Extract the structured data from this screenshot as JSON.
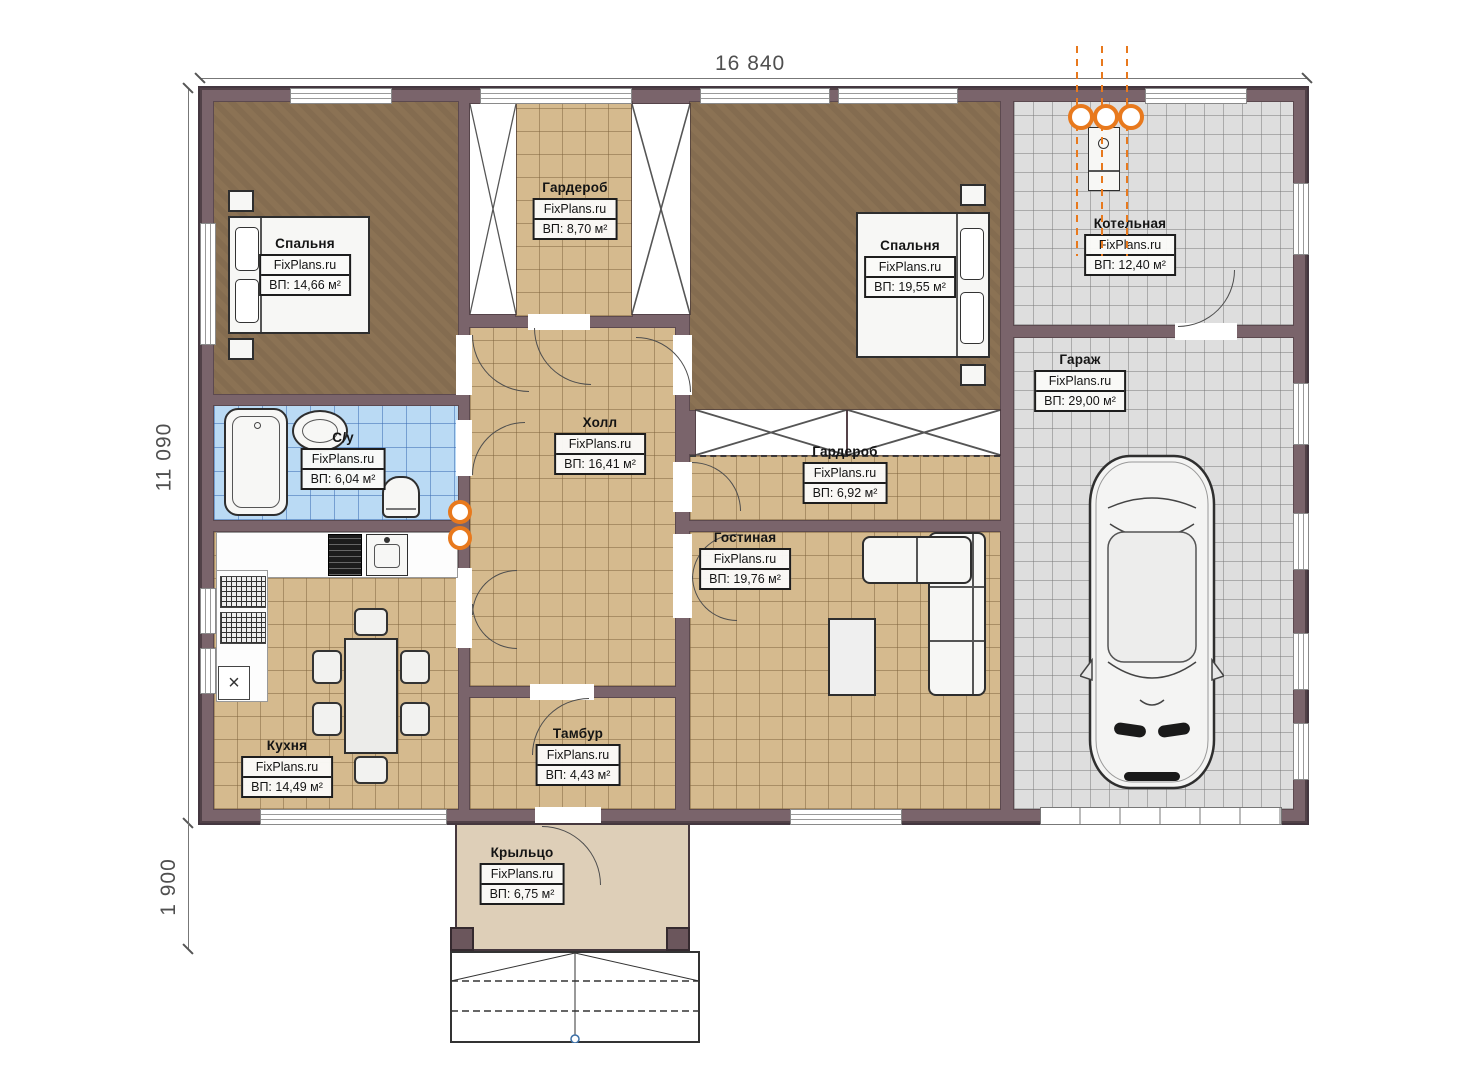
{
  "brand": "FixPlans.ru",
  "dimensions": {
    "top": "16 840",
    "left": "11 090",
    "bottom_left": "1 900"
  },
  "rooms": [
    {
      "id": "bedroom1",
      "name": "Спальня",
      "area": "ВП: 14,66 м²"
    },
    {
      "id": "wardrobe_top",
      "name": "Гардероб",
      "area": "ВП: 8,70 м²"
    },
    {
      "id": "bedroom2",
      "name": "Спальня",
      "area": "ВП: 19,55 м²"
    },
    {
      "id": "boiler",
      "name": "Котельная",
      "area": "ВП: 12,40 м²"
    },
    {
      "id": "garage",
      "name": "Гараж",
      "area": "ВП: 29,00 м²"
    },
    {
      "id": "bathroom",
      "name": "С/у",
      "area": "ВП: 6,04 м²"
    },
    {
      "id": "hall",
      "name": "Холл",
      "area": "ВП: 16,41 м²"
    },
    {
      "id": "wardrobe2",
      "name": "Гардероб",
      "area": "ВП: 6,92 м²"
    },
    {
      "id": "living",
      "name": "Гостиная",
      "area": "ВП: 19,76 м²"
    },
    {
      "id": "kitchen",
      "name": "Кухня",
      "area": "ВП: 14,49 м²"
    },
    {
      "id": "tambour",
      "name": "Тамбур",
      "area": "ВП: 4,43 м²"
    },
    {
      "id": "porch",
      "name": "Крыльцо",
      "area": "ВП: 6,75 м²"
    }
  ],
  "colors": {
    "wall": "#7a646b",
    "floor_wood": "#8b7254",
    "floor_tan": "#d5ba8e",
    "floor_blue": "#badaf4",
    "floor_gray": "#dedede",
    "porch": "#decfb8",
    "accent_orange": "#e8791d"
  }
}
